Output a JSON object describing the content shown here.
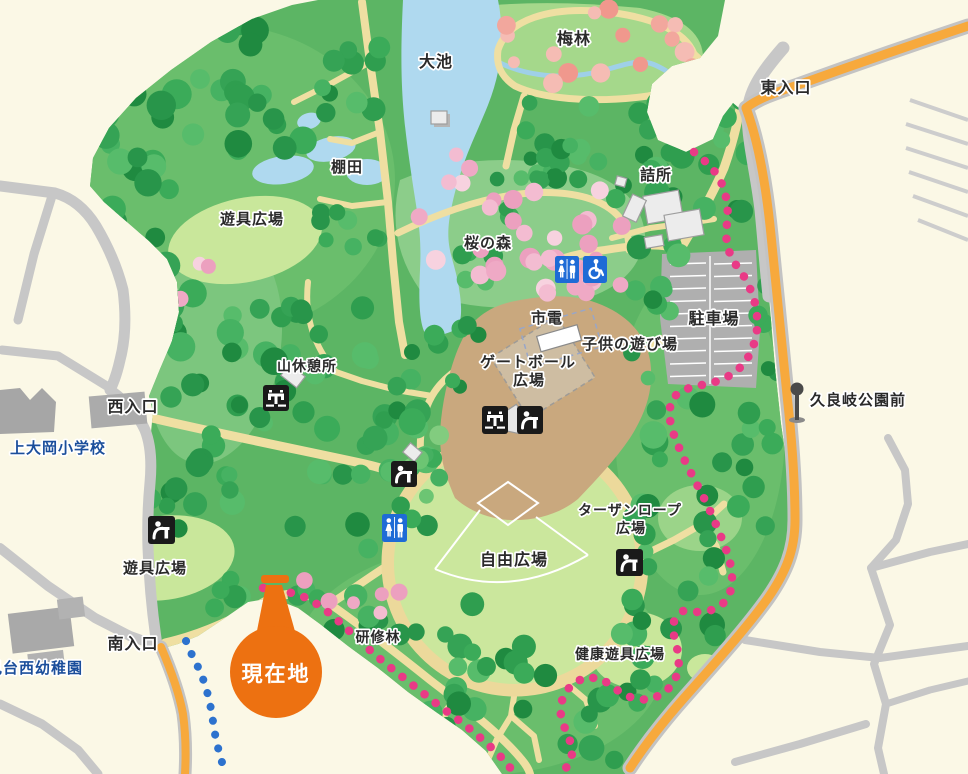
{
  "labels": {
    "oike": "大池",
    "bairin": "梅林",
    "higashi_entrance": "東入口",
    "tanada": "棚田",
    "yugu_hiroba_north": "遊具広場",
    "sakura_no_mori": "桜の森",
    "tsumesho": "詰所",
    "shiden": "市電",
    "kodomo_asobiba": "子供の遊び場",
    "chushajo": "駐車場",
    "gateball_line1": "ゲートボール",
    "gateball_line2": "広場",
    "yama_kyukeijo": "山休憩所",
    "nishi_entrance": "西入口",
    "school": "上大岡小学校",
    "tarzan_line1": "ターザンロープ",
    "tarzan_line2": "広場",
    "jiyu_hiroba": "自由広場",
    "bus_stop": "久良岐公園前",
    "yugu_hiroba_south": "遊具広場",
    "minami_entrance": "南入口",
    "kindergarten": "見台西幼稚園",
    "kenshurin": "研修林",
    "kenko_yugu_hiroba": "健康遊具広場",
    "current_location": "現在地"
  },
  "icons": {
    "restroom_icon": "man-woman-restroom",
    "accessible_icon": "wheelchair-access",
    "fountain_icon": "drinking-fountain",
    "faucet_icon": "water-tap",
    "bus_stop_icon": "bus-stop-pole",
    "current_location_icon": "orange-balloon-marker"
  },
  "colors": {
    "background_cream": "#FBF8E6",
    "park_green": "#5CB564",
    "forest_green": "#2F9E4F",
    "open_green": "#C9E79B",
    "water_blue": "#AFD9EF",
    "path_tan": "#EFDFA2",
    "plaza_brown": "#C9A87E",
    "parking_gray": "#AFAFAF",
    "road_gray": "#C7C7C7",
    "road_orange": "#F7A93C",
    "trail_pink": "#E93A86",
    "route_blue": "#2D72CE",
    "icon_blue": "#1E6BD6",
    "icon_black": "#1A1A1A",
    "label_blue": "#1B4E9B",
    "marker_orange": "#ED7111",
    "sakura_pink": "#F3BCD1",
    "ume_pink": "#F2A79D"
  }
}
